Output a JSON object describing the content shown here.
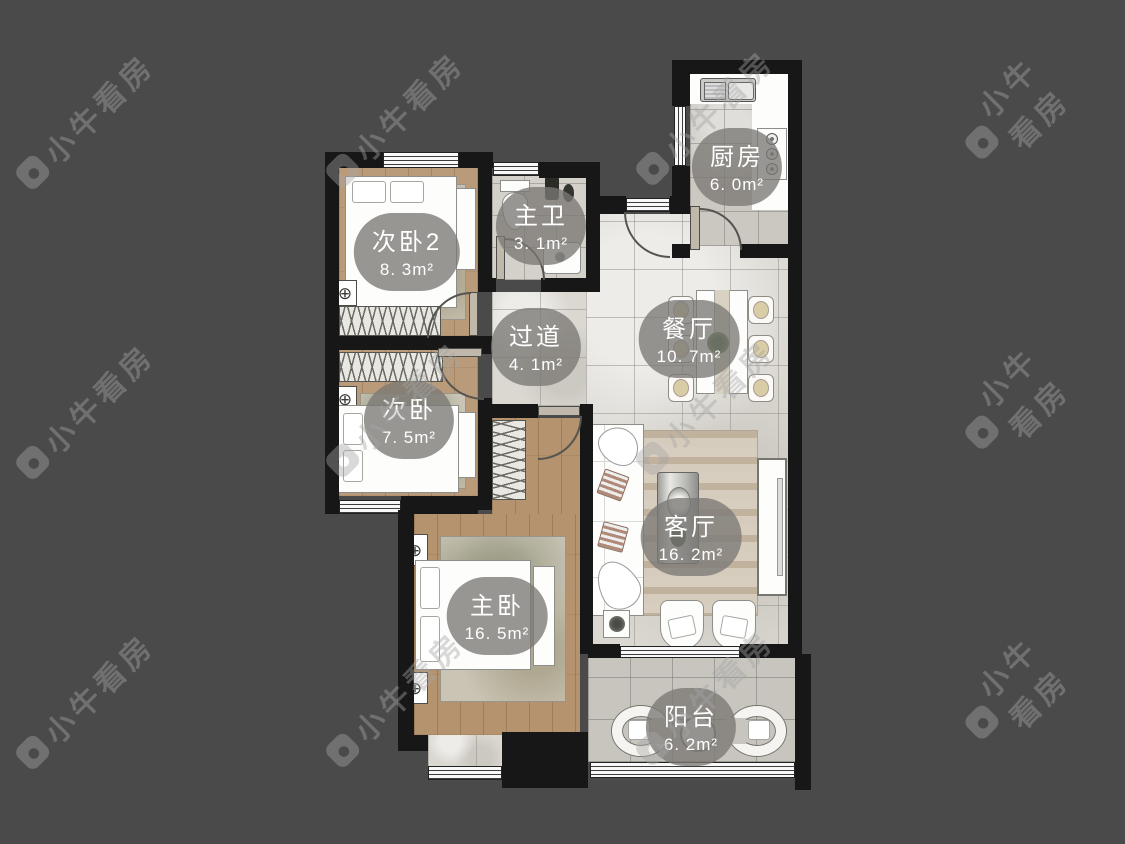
{
  "app": {
    "watermark_text": "小牛看房"
  },
  "rooms": [
    {
      "id": "bedroom2",
      "name": "次卧2",
      "area": "8. 3m²"
    },
    {
      "id": "master-bath",
      "name": "主卫",
      "area": "3. 1m²"
    },
    {
      "id": "kitchen",
      "name": "厨房",
      "area": "6. 0m²"
    },
    {
      "id": "hallway",
      "name": "过道",
      "area": "4. 1m²"
    },
    {
      "id": "dining",
      "name": "餐厅",
      "area": "10. 7m²"
    },
    {
      "id": "bedroom",
      "name": "次卧",
      "area": "7. 5m²"
    },
    {
      "id": "master-bedroom",
      "name": "主卧",
      "area": "16. 5m²"
    },
    {
      "id": "living",
      "name": "客厅",
      "area": "16. 2m²"
    },
    {
      "id": "balcony",
      "name": "阳台",
      "area": "6. 2m²"
    }
  ],
  "colors": {
    "background": "#4a4a4a",
    "wall": "#171717",
    "wood_floor": "#b99b79",
    "tile_floor": "#dbd8d2",
    "label_bg": "#7b7975",
    "label_text": "#ffffff"
  }
}
